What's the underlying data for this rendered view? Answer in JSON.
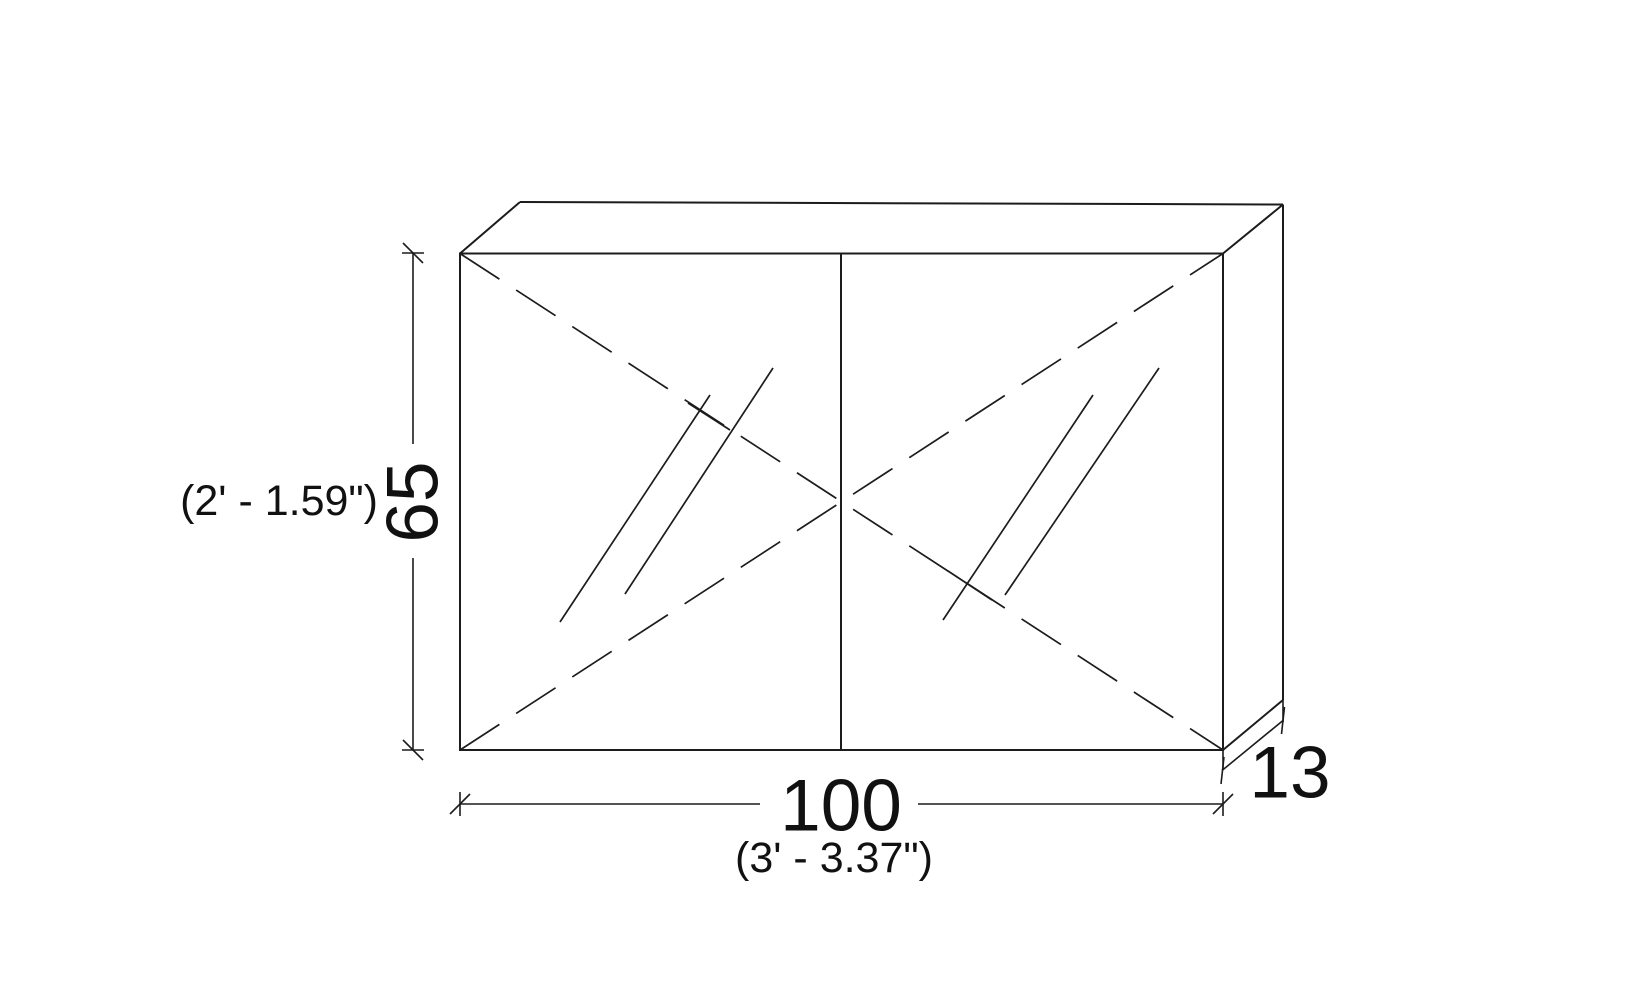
{
  "page": {
    "background": "#ffffff"
  },
  "drawing": {
    "kind": "double-door-mirrored-cabinet-elevation",
    "line_color": "#1c1c1c",
    "text_color": "#111111",
    "dimensions": {
      "height": {
        "primary": "65",
        "secondary": "(2' - 1.59\")"
      },
      "width": {
        "primary": "100",
        "secondary": "(3' - 3.37\")"
      },
      "depth": {
        "primary": "13"
      }
    }
  }
}
